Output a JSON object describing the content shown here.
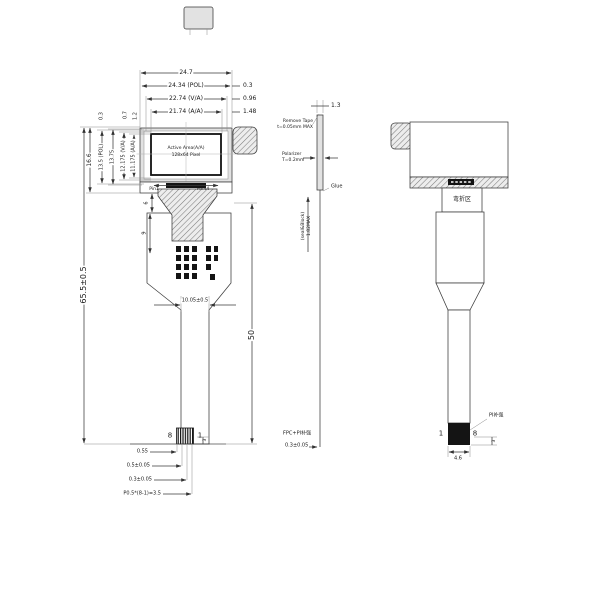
{
  "front": {
    "dims_top": [
      "24.7",
      "24.34 (POL)",
      "22.74 (V/A)",
      "21.74 (A/A)"
    ],
    "dims_right": [
      "0.3",
      "0.96",
      "1.48"
    ],
    "dims_left": [
      "16.6",
      "13.5 (POL)",
      "13.75",
      "12.175 (V/A)",
      "11.175 (A/A)"
    ],
    "dims_left_top": [
      "0.3",
      "0.7",
      "1.2"
    ],
    "aa1": "Active Area(A/A)",
    "aa2": "128x64 Pixel",
    "pin1": "Pin1",
    "pin44": "Pin44",
    "d6": "6",
    "d9": "9",
    "total": "65.5±0.5",
    "tailw": "10.05±0.5",
    "taill": "50",
    "c8": "8",
    "c1": "1",
    "cd": [
      "0.55",
      "0.5±0.05",
      "0.3±0.05",
      "P0.5*(8-1)=3.5"
    ],
    "c3": "3"
  },
  "side": {
    "t13": "1.3",
    "tape1": "Remove Tape",
    "tape2": "t=0.05mm MAX",
    "pol1": "Polarizer",
    "pol2": "T=0.2mm",
    "glue": "Glue",
    "th1": "1.82MAX",
    "th2": "(seal&Block)",
    "fpc1": "FPC+PI补强",
    "fpc2": "0.3±0.05"
  },
  "back": {
    "bend": "弯折区",
    "p1": "1",
    "p8": "8",
    "stiff": "PI补强",
    "w46": "4.6",
    "h3": "3"
  }
}
